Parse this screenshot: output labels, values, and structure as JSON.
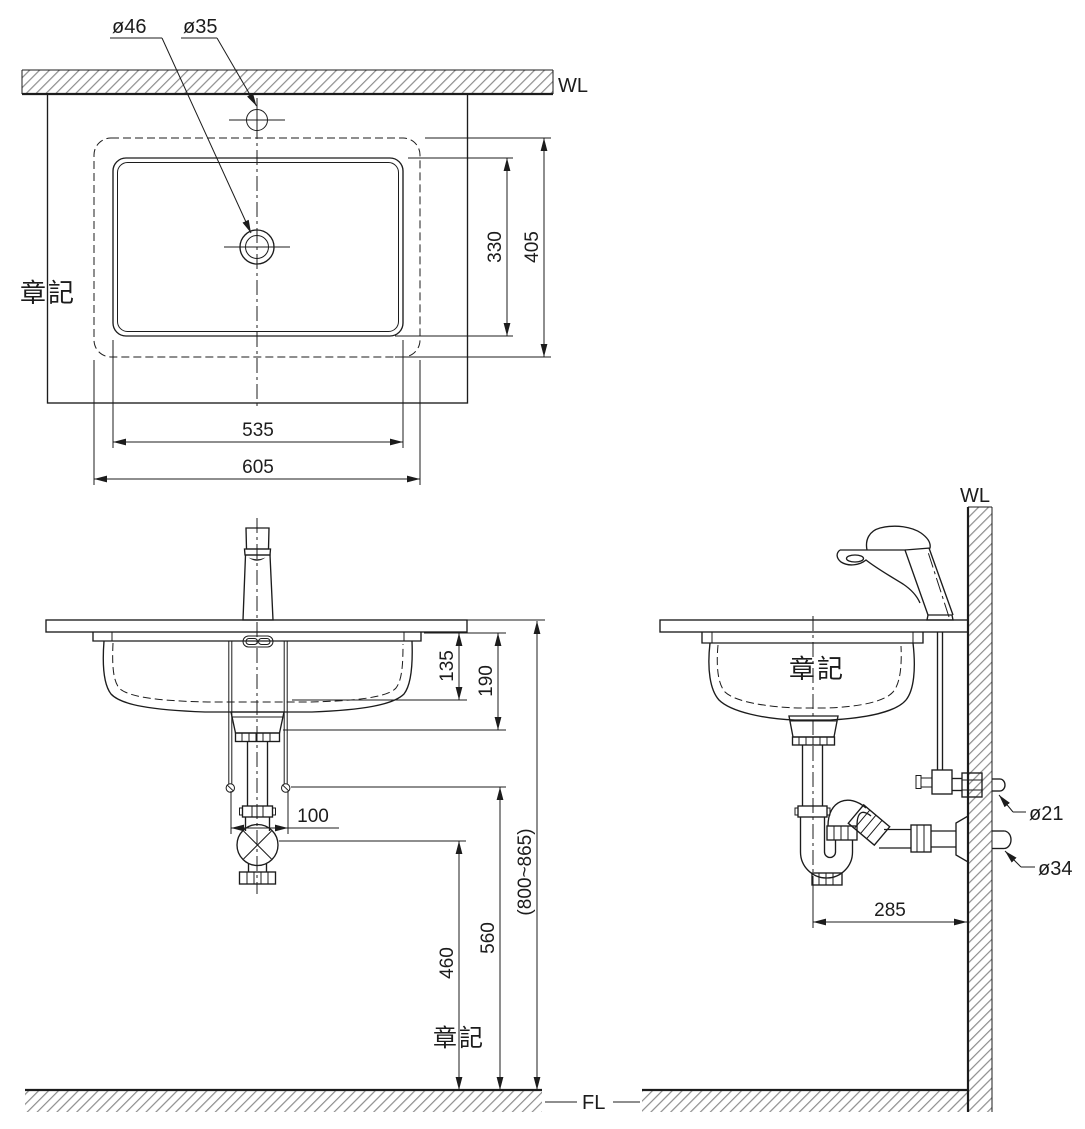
{
  "watermarks": {
    "stamp": "章記"
  },
  "levels": {
    "wl_top": "WL",
    "wl_side": "WL",
    "fl": "FL"
  },
  "top_view": {
    "drain_dia": "ø46",
    "hole_dia": "ø35",
    "bowl_depth": "330",
    "rim_depth": "405",
    "bowl_width": "535",
    "rim_width": "605"
  },
  "front_view": {
    "bowl_inner_height": "135",
    "bowl_overall_height": "190",
    "bolt_spacing": "100",
    "outlet_height": "460",
    "rod_height": "560",
    "counter_height": "(800~865)"
  },
  "side_view": {
    "supply_dia": "ø21",
    "outlet_dia": "ø34",
    "trap_offset": "285"
  }
}
